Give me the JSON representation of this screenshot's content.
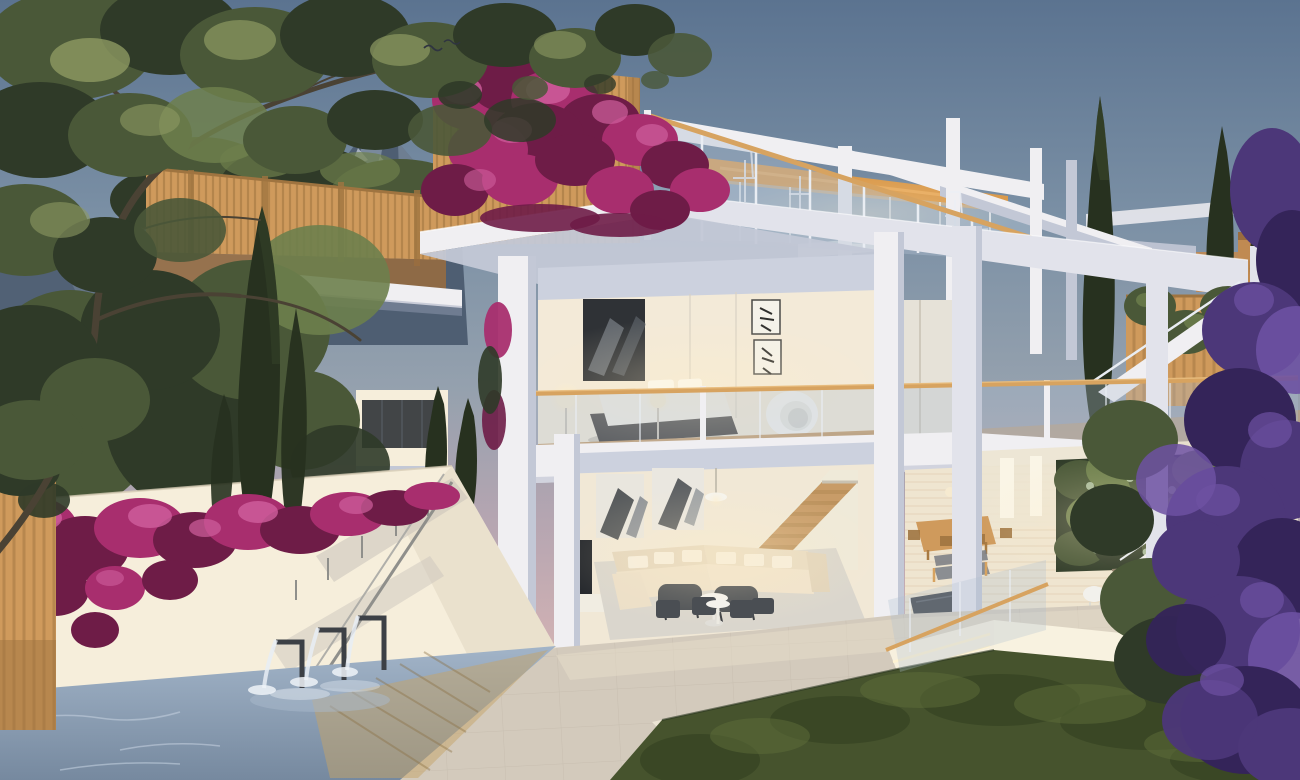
{
  "image": {
    "width": 1300,
    "height": 780
  },
  "scene": {
    "type": "architectural-render",
    "setting": "modern three-storey villa at dusk",
    "elements": [
      "evening sky",
      "mountain peak",
      "overhanging tree canopy",
      "cypress trees",
      "neighbouring terrace with timber slat screen",
      "bougainvillea in bloom",
      "roof terrace with glass railing and timber handrail",
      "penthouse lounge with timber ceiling",
      "open pergola frames",
      "bedroom with artwork, bed and egg chair",
      "living room with sectional sofa, staircase and TV",
      "dining terrace with living plant wall",
      "long outdoor dining table with chairs",
      "sun loungers",
      "white retaining wall with stair handrail",
      "water feature spouts",
      "swimming pool with timber deck",
      "stone paved terrace",
      "sunken lawn with accent lighting",
      "purple flowering tree",
      "distant villas",
      "birds"
    ]
  },
  "palette": {
    "sky_top": "#5b7390",
    "sky_upper": "#7b90a5",
    "sky_mid": "#95a1ae",
    "sky_mauve": "#b4a5b1",
    "sky_pink": "#ccafb3",
    "sky_horizon": "#e2c6b6",
    "mountain": "#4e5e72",
    "mountain_light": "#8494a6",
    "snow": "#b6c0cb",
    "foliage": "#4a5838",
    "foliage_dark": "#2f3a28",
    "foliage_light": "#6d7f4c",
    "foliage_olive": "#8d9a62",
    "cypress": "#27311f",
    "cypress_light": "#3d4c2e",
    "wood_slat": "#cf9a5c",
    "wood_slat_dark": "#9f7440",
    "wood_rail": "#d7a360",
    "bougainvillea": "#a82e6e",
    "bougainvillea_light": "#cf5f9d",
    "bougainvillea_dark": "#6e1c47",
    "purple": "#4c3779",
    "purple_light": "#6d51a2",
    "purple_dark": "#342459",
    "white_lit": "#f0eff2",
    "white_mid": "#e2e3eb",
    "white_warm": "#f6eedb",
    "white_shadow": "#c3c8d6",
    "white_deep": "#9aa2b8",
    "glass": "#aebfd0",
    "interior": "#f3ead8",
    "interior_glow": "#ffeec8",
    "floor_wood": "#c89c68",
    "stair_wood": "#d9b27c",
    "stair_wood_dark": "#b68e58",
    "ceiling_wood": "#da9a4c",
    "ceiling_int": "#ccd1de",
    "water_light": "#a2b4c8",
    "water_dark": "#76899f",
    "foam": "#eef3f8",
    "stone": "#d3cabc",
    "stone_dark": "#b6ad9f",
    "stone_lit": "#e7ddc9",
    "deck_wood": "#c6a368",
    "grass": "#46532d",
    "grass_dark": "#32401f",
    "grass_light": "#5e6d3a",
    "led": "#fff3d2",
    "metal": "#3c4046",
    "rail_gray": "#8f8f8b",
    "tan": "#c08a52",
    "tan_dark": "#9a6c3e",
    "art": "#2f3236",
    "branch": "#4a4234",
    "chair_dark": "#4a4e53"
  }
}
